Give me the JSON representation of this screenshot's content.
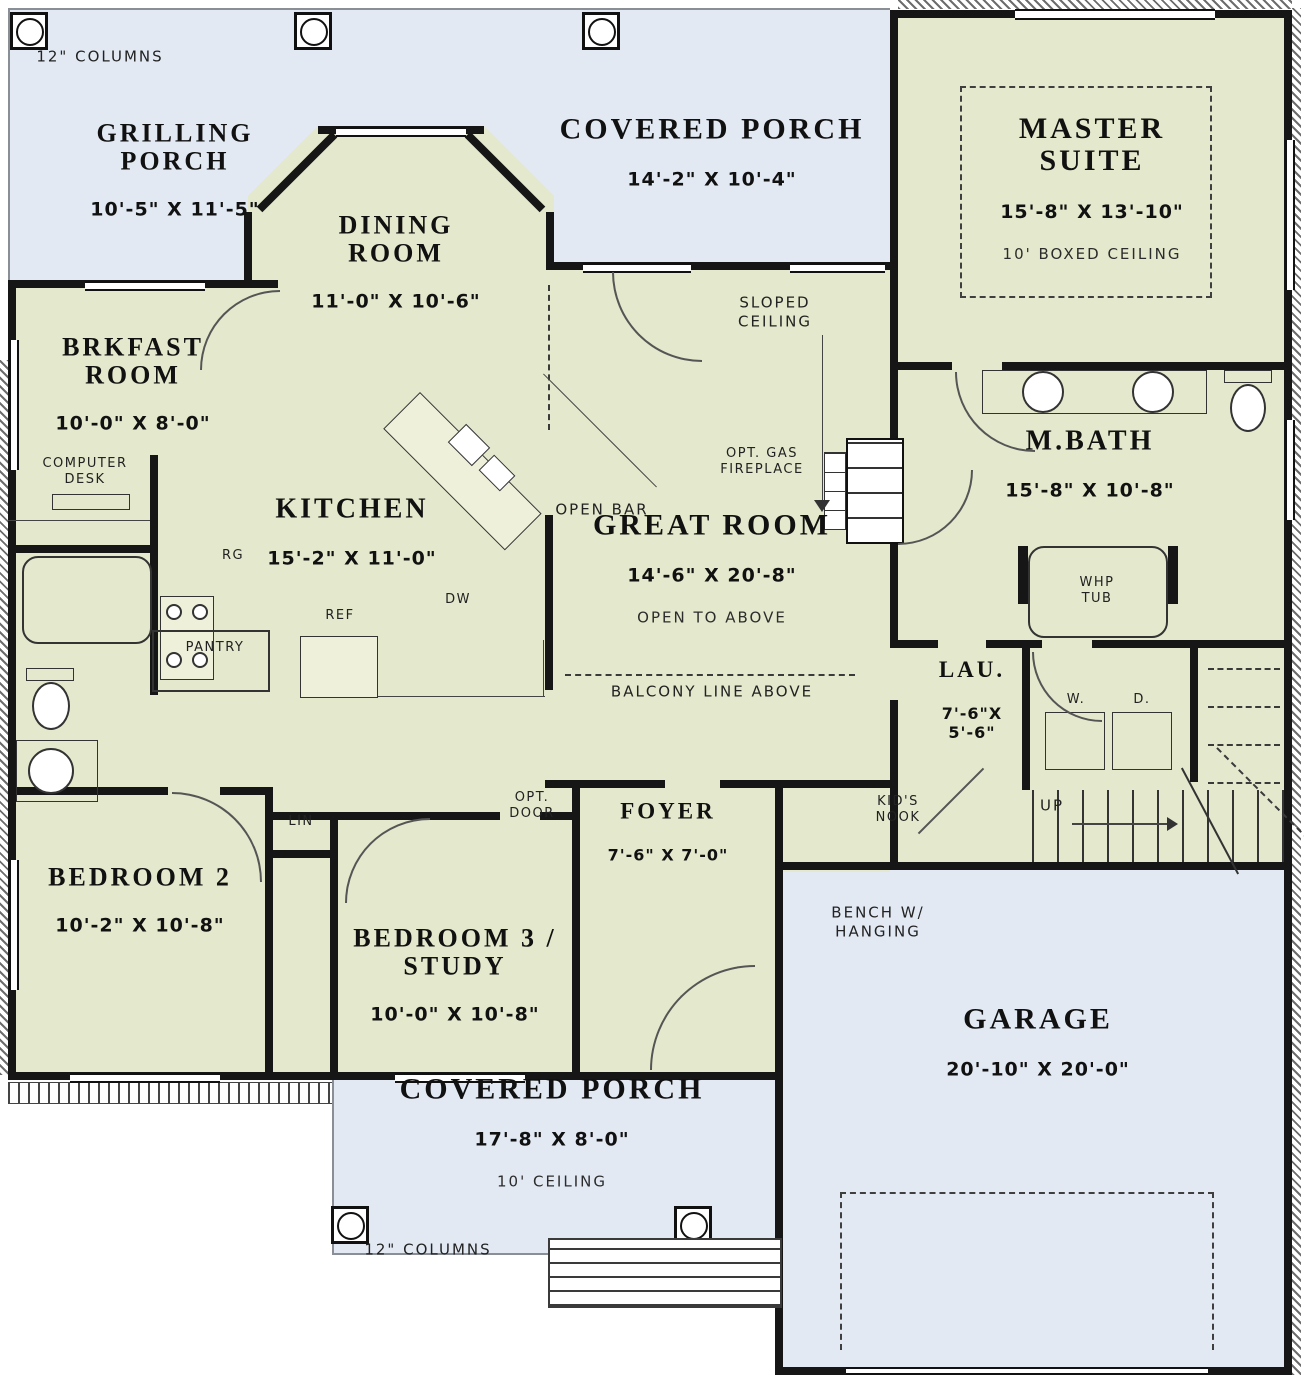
{
  "plan": {
    "colors": {
      "interior": "#e4e8cc",
      "porch": "#e2e9f3",
      "wall": "#161616"
    },
    "notes": {
      "columns_top": "12\" COLUMNS",
      "columns_bottom": "12\" COLUMNS"
    },
    "rooms": {
      "grilling_porch": {
        "name": "GRILLING\nPORCH",
        "dims": "10'-5\" X 11'-5\""
      },
      "covered_porch_top": {
        "name": "COVERED PORCH",
        "dims": "14'-2\" X 10'-4\""
      },
      "master_suite": {
        "name": "MASTER\nSUITE",
        "dims": "15'-8\" X 13'-10\"",
        "note": "10' BOXED CEILING"
      },
      "dining_room": {
        "name": "DINING\nROOM",
        "dims": "11'-0\" X 10'-6\""
      },
      "brkfast_room": {
        "name": "BRKFAST\nROOM",
        "dims": "10'-0\" X 8'-0\""
      },
      "kitchen": {
        "name": "KITCHEN",
        "dims": "15'-2\" X 11'-0\""
      },
      "great_room": {
        "name": "GREAT ROOM",
        "dims": "14'-6\" X 20'-8\"",
        "note": "OPEN TO ABOVE"
      },
      "m_bath": {
        "name": "M.BATH",
        "dims": "15'-8\" X 10'-8\""
      },
      "laundry": {
        "name": "LAU.",
        "dims": "7'-6\"X\n5'-6\""
      },
      "foyer": {
        "name": "FOYER",
        "dims": "7'-6\" X 7'-0\""
      },
      "bedroom_2": {
        "name": "BEDROOM 2",
        "dims": "10'-2\" X 10'-8\""
      },
      "bedroom_3": {
        "name": "BEDROOM 3 /\nSTUDY",
        "dims": "10'-0\" X 10'-8\""
      },
      "garage": {
        "name": "GARAGE",
        "dims": "20'-10\" X 20'-0\""
      },
      "covered_porch_bottom": {
        "name": "COVERED PORCH",
        "dims": "17'-8\" X 8'-0\"",
        "note": "10' CEILING"
      }
    },
    "annotations": {
      "sloped_ceiling": "SLOPED\nCEILING",
      "computer_desk": "COMPUTER\nDESK",
      "open_bar": "OPEN BAR",
      "opt_gas_fireplace": "OPT. GAS\nFIREPLACE",
      "balcony_line": "BALCONY LINE ABOVE",
      "whp_tub": "WHP\nTUB",
      "washer": "W.",
      "dryer": "D.",
      "up": "UP",
      "kids_nook": "KID'S\nNOOK",
      "linen": "LIN",
      "opt_door": "OPT.\nDOOR",
      "bench": "BENCH W/\nHANGING",
      "range": "RG",
      "refrigerator": "REF",
      "dishwasher": "DW",
      "pantry": "PANTRY"
    }
  }
}
